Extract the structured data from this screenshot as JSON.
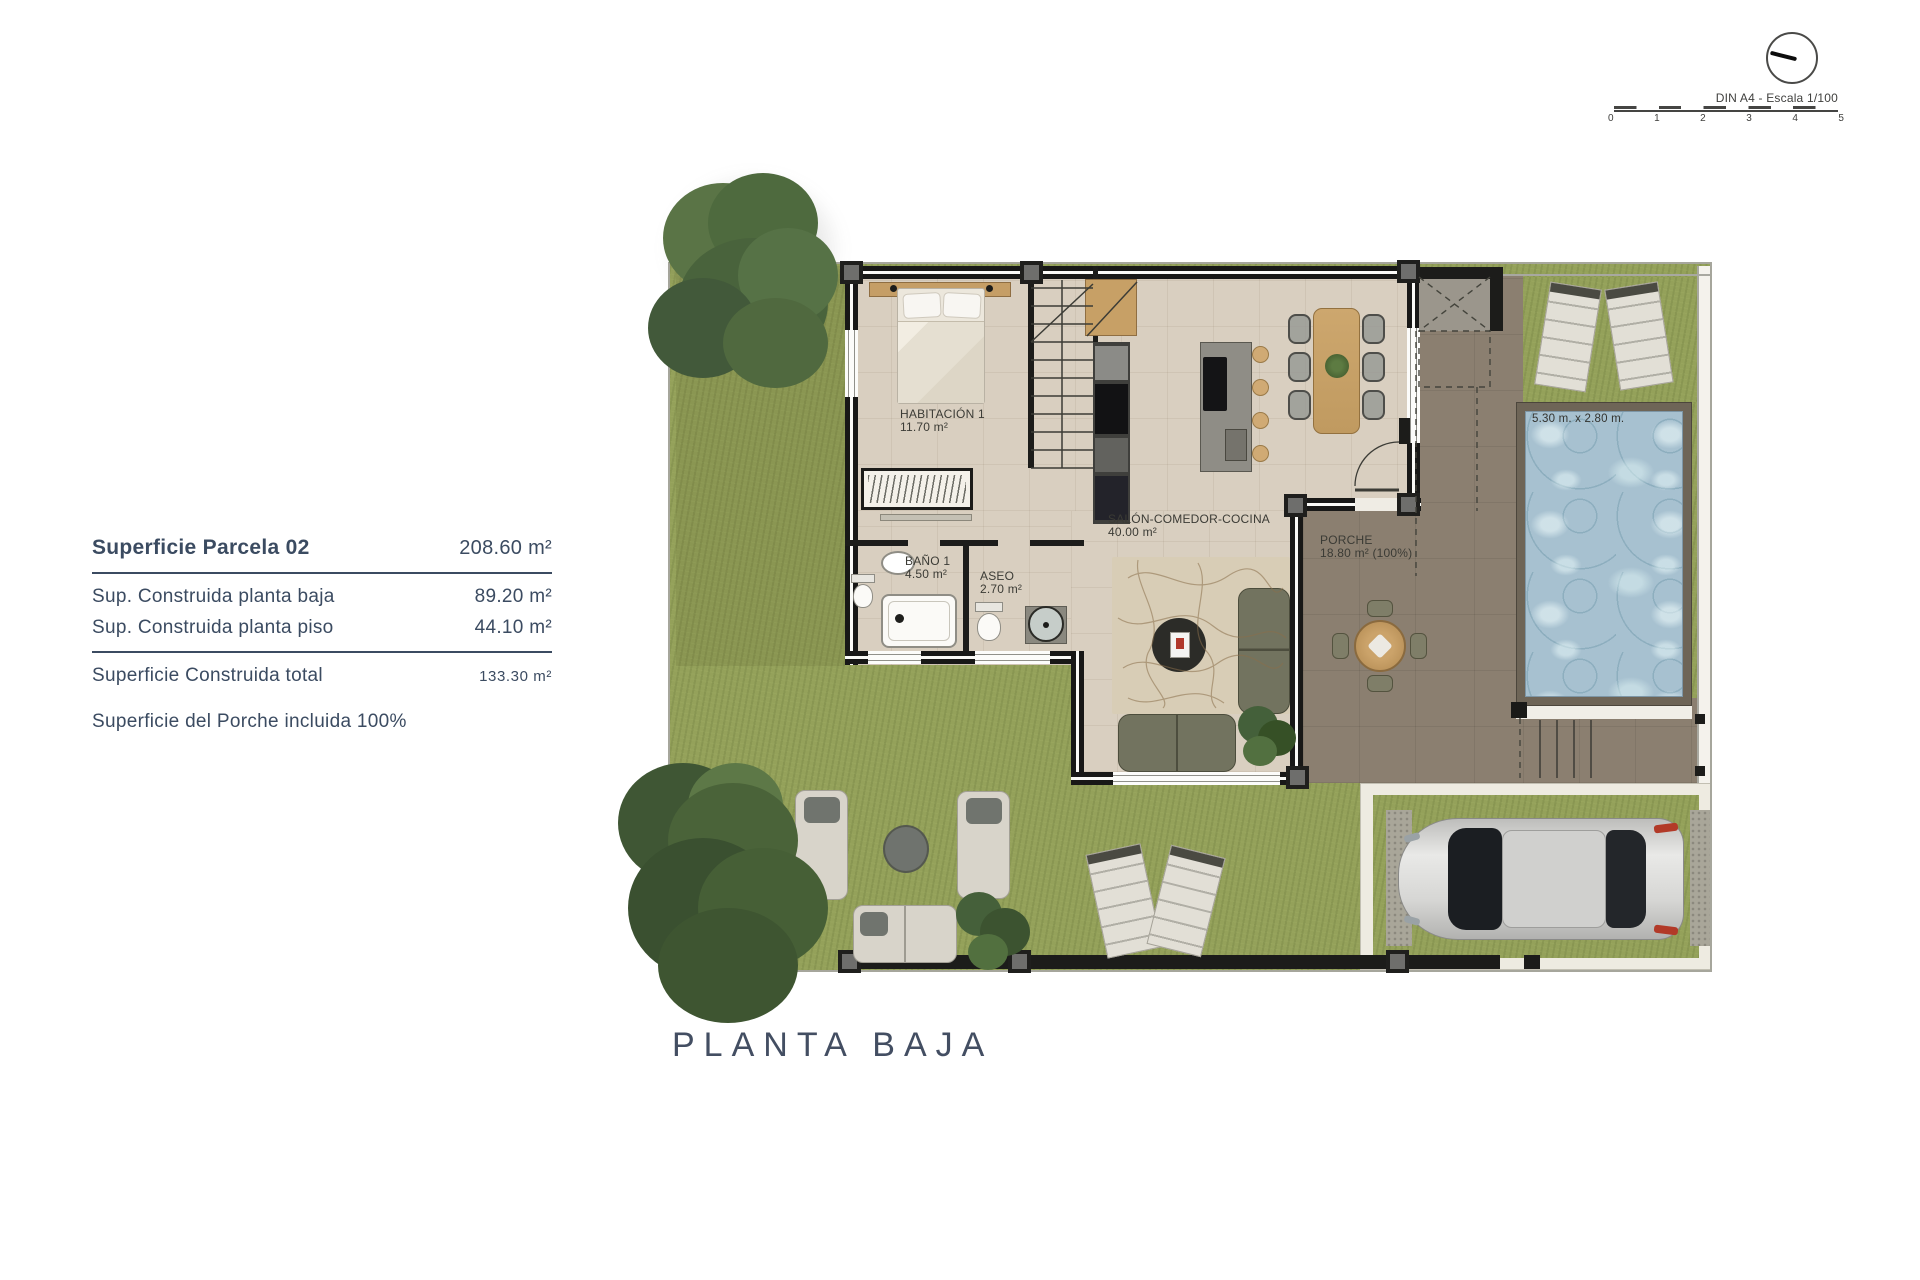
{
  "scale": {
    "label": "DIN A4 - Escala 1/100",
    "ticks": [
      "0",
      "1",
      "2",
      "3",
      "4",
      "5"
    ]
  },
  "summary": {
    "parcela_label": "Superficie Parcela 02",
    "parcela_value": "208.60 m²",
    "row1_label": "Sup. Construida planta baja",
    "row1_value": "89.20 m²",
    "row2_label": "Sup. Construida planta piso",
    "row2_value": "44.10 m²",
    "total_label": "Superficie Construida total",
    "total_value": "133.30 m²",
    "note": "Superficie del Porche incluida 100%"
  },
  "plan": {
    "title": "PLANTA BAJA",
    "rooms": {
      "habitacion": {
        "name": "HABITACIÓN 1",
        "area": "11.70 m²"
      },
      "bano": {
        "name": "BAÑO 1",
        "area": "4.50 m²"
      },
      "aseo": {
        "name": "ASEO",
        "area": "2.70 m²"
      },
      "salon": {
        "name": "SALÓN-COMEDOR-COCINA",
        "area": "40.00 m²"
      },
      "porche": {
        "name": "PORCHE",
        "area": "18.80 m² (100%)"
      }
    },
    "pool": {
      "dimensions": "5.30 m. x 2.80 m."
    }
  },
  "icons": {
    "compass": "north-arrow-circle"
  },
  "colors": {
    "text_navy": "#3b4b61",
    "plan_ink": "#3b3b35",
    "grass": "#94a15a",
    "floor": "#d9cfc0",
    "terrace": "#8b7f70",
    "pool_water": "#a7c1d0",
    "wood": "#c7a066"
  }
}
